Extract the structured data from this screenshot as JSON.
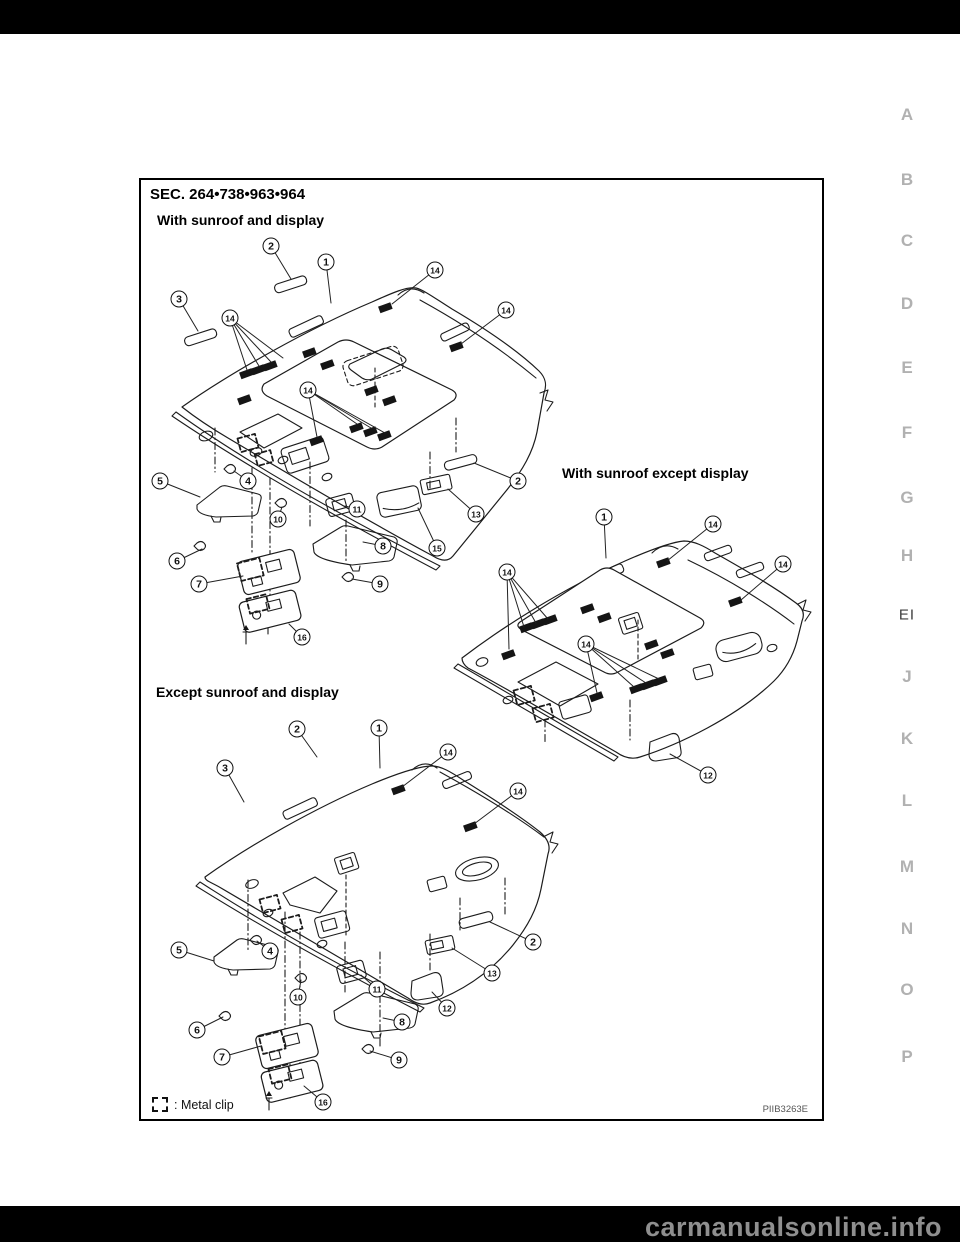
{
  "watermark": "carmanualsonline.info",
  "figure": {
    "section": "SEC. 264•738•963•964",
    "code": "PIIB3263E",
    "legend_label": ": Metal clip",
    "diagrams": [
      {
        "label": "With sunroof and display",
        "callouts": [
          {
            "n": "2",
            "x": 271,
            "y": 246,
            "to": [
              [
                291,
                279
              ]
            ]
          },
          {
            "n": "1",
            "x": 326,
            "y": 262,
            "to": [
              [
                331,
                303
              ]
            ]
          },
          {
            "n": "14",
            "x": 435,
            "y": 270,
            "to": [
              [
                392,
                304
              ]
            ]
          },
          {
            "n": "3",
            "x": 179,
            "y": 299,
            "to": [
              [
                198,
                331
              ]
            ]
          },
          {
            "n": "14",
            "x": 230,
            "y": 318,
            "to": [
              [
                247,
                370
              ],
              [
                259,
                366
              ],
              [
                271,
                362
              ],
              [
                283,
                358
              ]
            ]
          },
          {
            "n": "14",
            "x": 506,
            "y": 310,
            "to": [
              [
                461,
                344
              ]
            ]
          },
          {
            "n": "14",
            "x": 308,
            "y": 390,
            "to": [
              [
                317,
                437
              ],
              [
                357,
                424
              ],
              [
                371,
                428
              ],
              [
                385,
                433
              ]
            ]
          },
          {
            "n": "5",
            "x": 160,
            "y": 481,
            "to": [
              [
                200,
                497
              ]
            ]
          },
          {
            "n": "4",
            "x": 248,
            "y": 481,
            "to": [
              [
                234,
                471
              ]
            ]
          },
          {
            "n": "2",
            "x": 518,
            "y": 481,
            "to": [
              [
                474,
                463
              ]
            ]
          },
          {
            "n": "10",
            "x": 278,
            "y": 519,
            "to": [
              [
                282,
                507
              ]
            ]
          },
          {
            "n": "11",
            "x": 357,
            "y": 509,
            "to": [
              [
                345,
                506
              ]
            ]
          },
          {
            "n": "13",
            "x": 476,
            "y": 514,
            "to": [
              [
                448,
                489
              ]
            ]
          },
          {
            "n": "15",
            "x": 437,
            "y": 548,
            "to": [
              [
                418,
                508
              ]
            ]
          },
          {
            "n": "6",
            "x": 177,
            "y": 561,
            "to": [
              [
                202,
                549
              ]
            ]
          },
          {
            "n": "8",
            "x": 383,
            "y": 546,
            "to": [
              [
                363,
                542
              ]
            ]
          },
          {
            "n": "7",
            "x": 199,
            "y": 584,
            "to": [
              [
                243,
                576
              ]
            ]
          },
          {
            "n": "9",
            "x": 380,
            "y": 584,
            "to": [
              [
                352,
                579
              ]
            ]
          },
          {
            "n": "16",
            "x": 302,
            "y": 637,
            "to": [
              [
                289,
                624
              ]
            ]
          }
        ]
      },
      {
        "label": "With sunroof except display",
        "callouts": [
          {
            "n": "1",
            "x": 604,
            "y": 517,
            "to": [
              [
                606,
                558
              ]
            ]
          },
          {
            "n": "14",
            "x": 713,
            "y": 524,
            "to": [
              [
                667,
                561
              ]
            ]
          },
          {
            "n": "14",
            "x": 783,
            "y": 564,
            "to": [
              [
                741,
                600
              ]
            ]
          },
          {
            "n": "14",
            "x": 507,
            "y": 572,
            "to": [
              [
                509,
                649
              ],
              [
                524,
                627
              ],
              [
                536,
                623
              ],
              [
                548,
                619
              ]
            ]
          },
          {
            "n": "14",
            "x": 586,
            "y": 644,
            "to": [
              [
                597,
                693
              ],
              [
                634,
                687
              ],
              [
                646,
                683
              ],
              [
                659,
                679
              ]
            ]
          },
          {
            "n": "12",
            "x": 708,
            "y": 775,
            "to": [
              [
                670,
                754
              ]
            ]
          }
        ]
      },
      {
        "label": "Except sunroof and display",
        "callouts": [
          {
            "n": "2",
            "x": 297,
            "y": 729,
            "to": [
              [
                317,
                757
              ]
            ]
          },
          {
            "n": "1",
            "x": 379,
            "y": 728,
            "to": [
              [
                380,
                768
              ]
            ]
          },
          {
            "n": "3",
            "x": 225,
            "y": 768,
            "to": [
              [
                244,
                802
              ]
            ]
          },
          {
            "n": "14",
            "x": 448,
            "y": 752,
            "to": [
              [
                402,
                787
              ]
            ]
          },
          {
            "n": "14",
            "x": 518,
            "y": 791,
            "to": [
              [
                474,
                824
              ]
            ]
          },
          {
            "n": "5",
            "x": 179,
            "y": 950,
            "to": [
              [
                214,
                961
              ]
            ]
          },
          {
            "n": "4",
            "x": 270,
            "y": 951,
            "to": [
              [
                257,
                941
              ]
            ]
          },
          {
            "n": "2",
            "x": 533,
            "y": 942,
            "to": [
              [
                490,
                922
              ]
            ]
          },
          {
            "n": "13",
            "x": 492,
            "y": 973,
            "to": [
              [
                452,
                948
              ]
            ]
          },
          {
            "n": "10",
            "x": 298,
            "y": 997,
            "to": [
              [
                301,
                980
              ]
            ]
          },
          {
            "n": "11",
            "x": 377,
            "y": 989,
            "to": [
              [
                361,
                975
              ]
            ]
          },
          {
            "n": "12",
            "x": 447,
            "y": 1008,
            "to": [
              [
                432,
                992
              ]
            ]
          },
          {
            "n": "6",
            "x": 197,
            "y": 1030,
            "to": [
              [
                223,
                1017
              ]
            ]
          },
          {
            "n": "8",
            "x": 402,
            "y": 1022,
            "to": [
              [
                383,
                1018
              ]
            ]
          },
          {
            "n": "7",
            "x": 222,
            "y": 1057,
            "to": [
              [
                261,
                1046
              ]
            ]
          },
          {
            "n": "9",
            "x": 399,
            "y": 1060,
            "to": [
              [
                370,
                1051
              ]
            ]
          },
          {
            "n": "16",
            "x": 323,
            "y": 1102,
            "to": [
              [
                304,
                1086
              ]
            ]
          }
        ]
      }
    ]
  },
  "side_tabs": [
    {
      "label": "A",
      "y": 115
    },
    {
      "label": "B",
      "y": 180
    },
    {
      "label": "C",
      "y": 241
    },
    {
      "label": "D",
      "y": 304
    },
    {
      "label": "E",
      "y": 368
    },
    {
      "label": "F",
      "y": 433
    },
    {
      "label": "G",
      "y": 498
    },
    {
      "label": "H",
      "y": 556
    },
    {
      "label": "EI",
      "y": 615,
      "current": true
    },
    {
      "label": "J",
      "y": 677
    },
    {
      "label": "K",
      "y": 739
    },
    {
      "label": "L",
      "y": 801
    },
    {
      "label": "M",
      "y": 867
    },
    {
      "label": "N",
      "y": 929
    },
    {
      "label": "O",
      "y": 990
    },
    {
      "label": "P",
      "y": 1057
    }
  ]
}
